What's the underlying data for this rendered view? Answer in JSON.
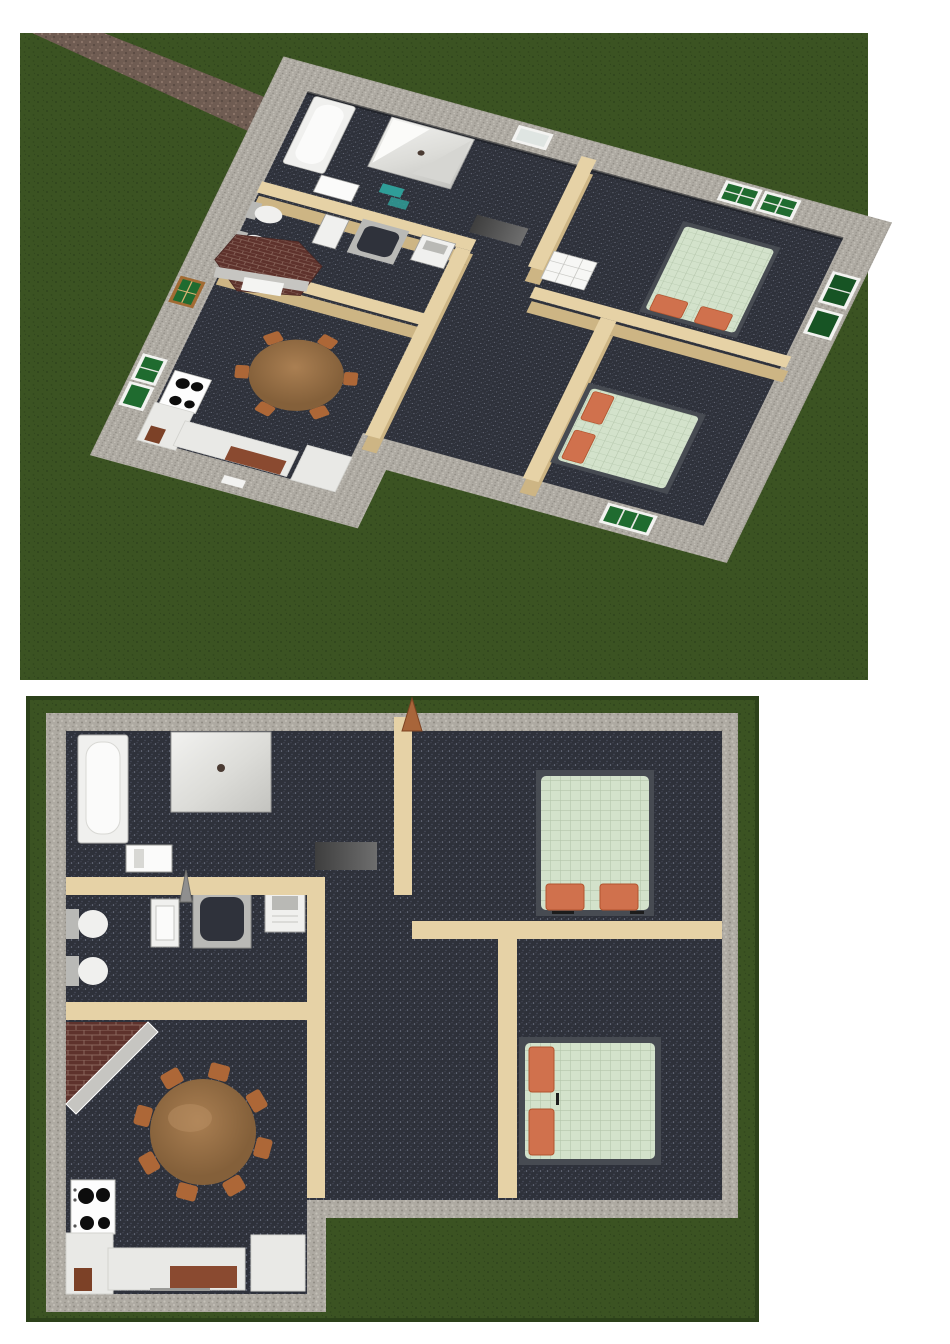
{
  "document": {
    "background": "#ffffff",
    "description_visible_text": ""
  },
  "palette": {
    "lawn": "#3b5322",
    "lawn_dot": "#2f451c",
    "lawn_edge": "#2c411a",
    "path_base": "#6f5c52",
    "path_dot": "#8d776a",
    "path_dot2": "#564740",
    "wall_gray": "#aeaaa2",
    "wall_gray_dot_d": "#908c84",
    "wall_gray_dot_l": "#c9c5bd",
    "wall_tan": "#e6d2a6",
    "wall_tan_shade": "#cdb584",
    "carpet": "#2e313a",
    "carpet_dot_l": "#7d8294",
    "carpet_dot_m": "#4c5161",
    "carpet_seam": "#15171d",
    "window_green": "#1f6b2f",
    "window_green_dark": "#175424",
    "window_frame": "#f3f3f1",
    "window_wood": "#a26b33",
    "bed_frame": "#474b52",
    "bed_cover": "#d3e2cb",
    "bed_grid": "#b4c6ab",
    "pillow": "#d0714d",
    "pillow_edge": "#b2542e",
    "brick": "#5e322c",
    "brick_mortar": "#8a675d",
    "hearth_band": "#c6c5c1",
    "table_wood": "#aa7f52",
    "table_wood_dark": "#84603a",
    "chair": "#ad6737",
    "counter": "#e9e9e6",
    "counter_edge": "#cfcfcb",
    "cabinet_brown": "#7c4127",
    "board_brown": "#8a4a30",
    "appliance": "#fdfdfd",
    "burner": "#0d0d0d",
    "fixture": "#f0f0ee",
    "fixture_edge": "#a6a6a3",
    "fixture_inner": "#fbfbfa",
    "basin_dark": "#2f323b",
    "metal_gray": "#b9b9b6",
    "drain": "#4a3b33",
    "dresser_dark": "#3e3e3e",
    "dresser_light": "#6e6e6e",
    "teal": "#2f9e98",
    "door_arrow": "#a8653a",
    "door_spike": "#8f8f8f",
    "door_white": "#f7f7f5"
  },
  "views": [
    {
      "id": "dollhouse-3d-view",
      "type": "3d-render",
      "objects": [
        "lawn",
        "stone-path",
        "stone-perimeter-walls",
        "brick-chimney",
        "bathtub",
        "shower",
        "toilets",
        "sinks",
        "dresser",
        "white-panel-door",
        "bed-double",
        "bed-double-2",
        "round-dining-table",
        "chairs",
        "stove-4-burners",
        "kitchen-counters",
        "green-shuttered-windows",
        "interior-tan-walls",
        "dark-carpet-floors"
      ]
    },
    {
      "id": "floor-plan-top-view",
      "type": "top-down-plan",
      "rooms": [
        {
          "name": "bathroom",
          "fixtures": [
            "bathtub",
            "shower-with-drain",
            "wall-cabinet",
            "dresser"
          ]
        },
        {
          "name": "wc",
          "fixtures": [
            "toilet",
            "toilet",
            "bidet",
            "vanity-basin",
            "sink"
          ]
        },
        {
          "name": "hallway",
          "fixtures": [
            "entry-door-arrow",
            "bathroom-door-arrow"
          ]
        },
        {
          "name": "bedroom-1",
          "fixtures": [
            "double-bed",
            "pillow",
            "pillow"
          ]
        },
        {
          "name": "bedroom-2",
          "fixtures": [
            "double-bed",
            "pillow",
            "pillow"
          ]
        },
        {
          "name": "dining-room",
          "fixtures": [
            "corner-brick-hearth",
            "round-table",
            "chairs-x8"
          ]
        },
        {
          "name": "kitchen",
          "fixtures": [
            "stove-4-burners",
            "l-shaped-counter",
            "counter-island",
            "cutting-boards"
          ]
        }
      ]
    }
  ]
}
